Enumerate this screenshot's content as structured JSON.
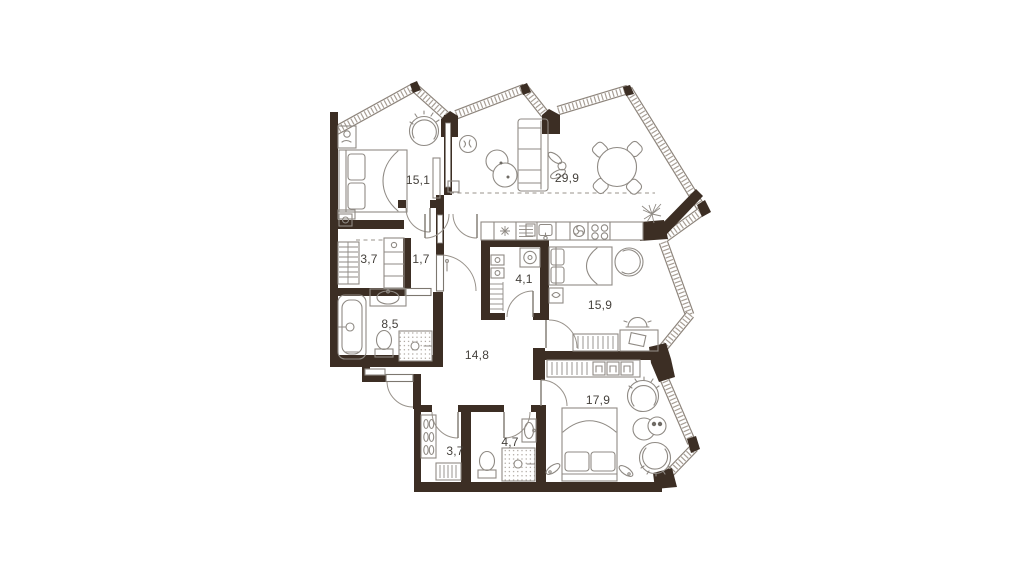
{
  "plan": {
    "title": "apartment-floor-plan",
    "rooms": [
      {
        "name": "bedroom-1",
        "area": "15,1"
      },
      {
        "name": "living-kitchen",
        "area": "29,9"
      },
      {
        "name": "wardrobe-1",
        "area": "3,7"
      },
      {
        "name": "hall",
        "area": "1,7"
      },
      {
        "name": "utility",
        "area": "4,1"
      },
      {
        "name": "bedroom-2",
        "area": "15,9"
      },
      {
        "name": "bathroom-1",
        "area": "8,5"
      },
      {
        "name": "corridor",
        "area": "14,8"
      },
      {
        "name": "bedroom-3",
        "area": "17,9"
      },
      {
        "name": "wardrobe-2",
        "area": "3,7"
      },
      {
        "name": "bathroom-2",
        "area": "4,7"
      }
    ],
    "colors": {
      "wall": "#3c2e24",
      "furniture": "#8f8a84",
      "window_hatch": "#a89f96",
      "window_edge": "#8d847b",
      "label": "#45413c"
    }
  }
}
